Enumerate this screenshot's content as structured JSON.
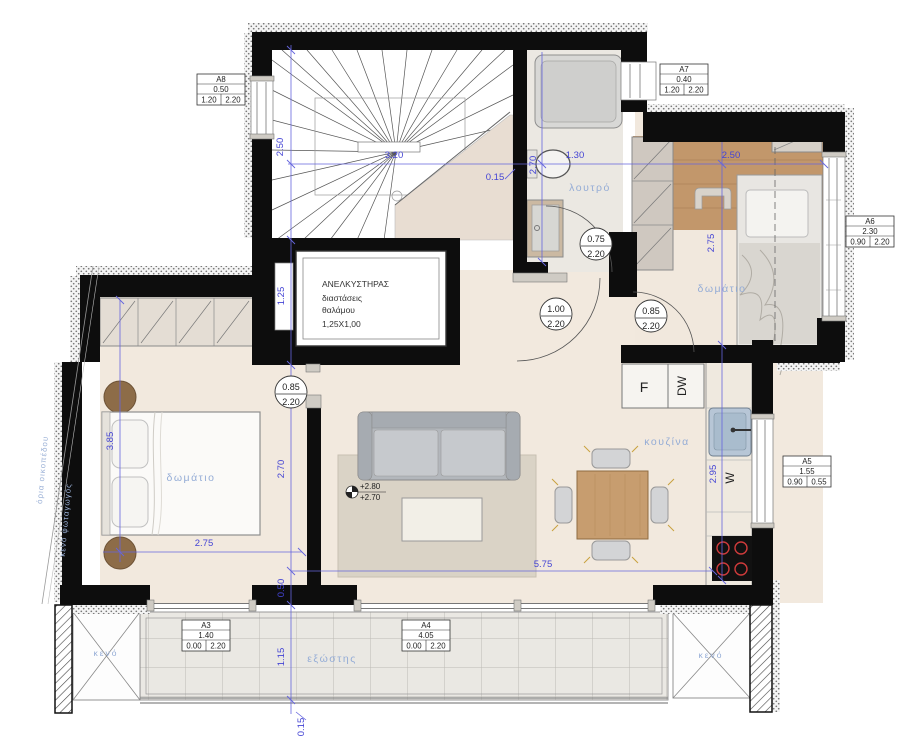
{
  "colors": {
    "wall": "#0d0d0d",
    "dim_text": "#4444d4",
    "room_label": "#94acd6",
    "wood_floor": "#c2976b",
    "cream_floor": "#f2e9de"
  },
  "rooms": {
    "bathroom": "λουτρό",
    "bedroom_left": "δωμάτιο",
    "bedroom_right": "δωμάτιο",
    "kitchen": "κουζίνα",
    "balcony": "εξώστης",
    "void_left": "κενό",
    "void_right": "κενό"
  },
  "site": {
    "plot_boundary": "όρια οικοπέδου",
    "lightwell": "κενό φωταγωγός"
  },
  "elevator": {
    "title": "ΑΝΕΛΚΥΣΤΗΡΑΣ",
    "line2": "διαστάσεις",
    "line3": "θαλάμου",
    "line4": "1,25X1,00"
  },
  "appliances": {
    "fridge": "F",
    "dishwasher": "DW",
    "washer": "W"
  },
  "levels": {
    "upper": "+2.80",
    "lower": "+2.70"
  },
  "dims": {
    "stair_width": "2.50",
    "stair_depth": "3.20",
    "bath_offset": "0.15",
    "bath_depth": "2.70",
    "bath_width": "1.30",
    "bed2_width": "2.50",
    "bed2_depth": "2.75",
    "elevator_width": "1.25",
    "bed1_depth": "3.85",
    "living_depth": "2.70",
    "bed1_width": "2.75",
    "living_width": "5.75",
    "kitchen_depth": "2.95",
    "balcony_depth": "1.15",
    "balcony_edge": "0.15",
    "door_offset": "0.50"
  },
  "door_tags": [
    {
      "width": "0.75",
      "height": "2.20"
    },
    {
      "width": "1.00",
      "height": "2.20"
    },
    {
      "width": "0.85",
      "height": "2.20"
    },
    {
      "width": "0.85",
      "height": "2.20"
    }
  ],
  "window_tags": [
    {
      "id": "A8",
      "width": "0.50",
      "sill": "1.20",
      "head": "2.20"
    },
    {
      "id": "A7",
      "width": "0.40",
      "sill": "1.20",
      "head": "2.20"
    },
    {
      "id": "A6",
      "width": "2.30",
      "sill": "0.90",
      "head": "2.20"
    },
    {
      "id": "A5",
      "width": "1.55",
      "sill": "0.90",
      "head": "0.55"
    },
    {
      "id": "A3",
      "width": "1.40",
      "sill": "0.00",
      "head": "2.20"
    },
    {
      "id": "A4",
      "width": "4.05",
      "sill": "0.00",
      "head": "2.20"
    }
  ]
}
